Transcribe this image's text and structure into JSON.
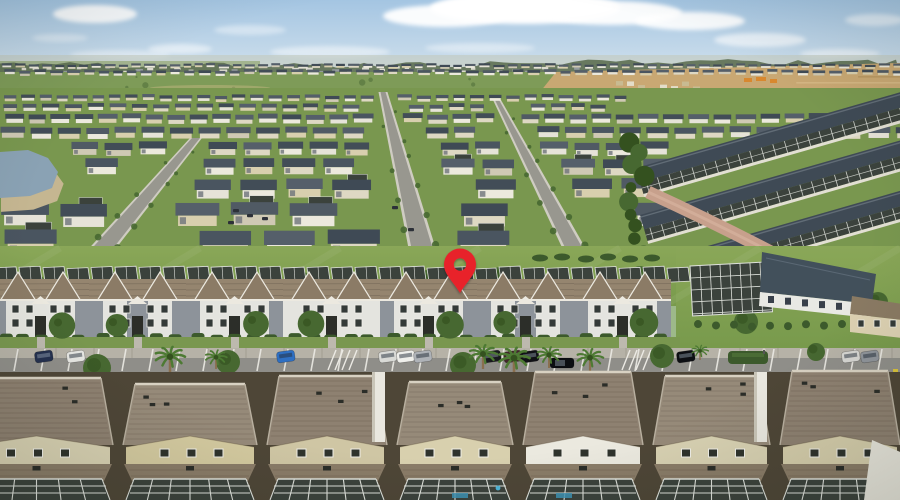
{
  "scene": {
    "description": "Aerial drone photo of a large suburban residential community: dense rows of houses stretching to the horizon under a blue sky with clouds, new construction land at upper right, a small pond at left, a row of two-story townhomes along a tree-lined parking street in the middle marked with a red map location pin, and large shingle roofs with screened pool enclosures in the foreground.",
    "marker": {
      "name": "map-pin",
      "x": 460,
      "top_y": 250,
      "tip_y": 293,
      "half_width": 16,
      "hole_cy": 264.5,
      "hole_radius": 6.2,
      "color": "#e8212b"
    },
    "palette": {
      "skyTop": "#a4c5e2",
      "skyMid": "#c6daea",
      "skyLow": "#dfe9ee",
      "cloud": "#ffffff",
      "haze": "#c3cbc0",
      "treeline": "#5d6f52",
      "treeline2": "#6b7d66",
      "fieldFar": "#9aad7e",
      "field": "#7e9b58",
      "fieldDot": "#5c7a42",
      "dirt": "#c9a873",
      "dirtLight": "#dcc190",
      "dirtDark": "#ad8c55",
      "orange": "#d8882f",
      "grass": "#79974f",
      "grassBelt1": "#8aa758",
      "grassBelt2": "#789a4c",
      "road": "#98978f",
      "roadEdge": "#cfccc2",
      "brick": "#c7a08c",
      "water": "#8aa2b4",
      "bank": "#c5b691",
      "roofs": [
        "#4a5560",
        "#3f4a55",
        "#555f6a",
        "#424d57",
        "#505a64"
      ],
      "walls": [
        "#ece9dd",
        "#ded8c3",
        "#d8cfae",
        "#e6e3d8",
        "#cfc9b4"
      ],
      "cage": "#3b423c",
      "cageFrame": "#dde0da",
      "townRoof": "#95856f",
      "townGable": "#8b7b66",
      "fascia": "#ece9e0",
      "facade": "#e4e4df",
      "facadeGray": "#8d939a",
      "windowDark": "#343a38",
      "trim": "#f0efe9",
      "porchDark": "#2c2e29",
      "hedge": "#3c5a2c",
      "tree": "#476831",
      "treeDark": "#34511f",
      "trunk": "#8a6f4e",
      "palm": "#4d7a33",
      "sidewalk": "#b6b2a7",
      "sidewalkJoint": "#a29d92",
      "asphalt": "#8f8e89",
      "stripe": "#eceae4",
      "foreBg": "#4e4637",
      "foreRoof": "#8e8171",
      "foreRoofAlt": "#968a79",
      "shingle": "rgba(64,52,40,0.18)",
      "ridge": "#d8d1c2",
      "lanai": "#8a7c68",
      "vent": "#2b2d28",
      "pool": "#3e93b5",
      "clubRoof": "#42505b",
      "clubWall": "#e9e9e4",
      "person": "#d8d4c8"
    },
    "sky": {
      "clouds": [
        [
          95,
          14,
          42,
          9,
          0.9
        ],
        [
          60,
          38,
          28,
          4,
          0.35
        ],
        [
          180,
          49,
          32,
          5,
          0.5
        ],
        [
          250,
          30,
          36,
          5,
          0.4
        ],
        [
          330,
          52,
          60,
          6,
          0.45
        ],
        [
          445,
          16,
          62,
          11,
          0.95
        ],
        [
          525,
          8,
          95,
          16,
          1
        ],
        [
          610,
          13,
          72,
          12,
          0.95
        ],
        [
          690,
          21,
          55,
          9,
          0.9
        ],
        [
          760,
          40,
          46,
          7,
          0.6
        ],
        [
          840,
          54,
          40,
          5,
          0.5
        ],
        [
          875,
          20,
          30,
          6,
          0.5
        ],
        [
          120,
          55,
          50,
          5,
          0.4
        ],
        [
          480,
          48,
          55,
          5,
          0.4
        ]
      ]
    },
    "development": {
      "rows": [
        {
          "y": 64,
          "h": 4,
          "x0": 0,
          "x1": 900
        },
        {
          "y": 70,
          "h": 5,
          "x0": 0,
          "x1": 900
        },
        {
          "y": 95,
          "h": 6,
          "x0": 0,
          "x1": 620
        },
        {
          "y": 104,
          "h": 7,
          "x0": 0,
          "x1": 610
        },
        {
          "y": 114,
          "h": 9,
          "x0": 0,
          "x1": 900
        },
        {
          "y": 127,
          "h": 11,
          "x0": 0,
          "x1": 900
        },
        {
          "y": 142,
          "h": 13,
          "x0": 0,
          "x1": 660
        },
        {
          "y": 159,
          "h": 16,
          "x0": 0,
          "x1": 655
        },
        {
          "y": 179,
          "h": 19,
          "x0": 0,
          "x1": 650
        },
        {
          "y": 203,
          "h": 23,
          "x0": 0,
          "x1": 645
        },
        {
          "y": 230,
          "h": 26,
          "x0": 0,
          "x1": 640
        }
      ],
      "streets": [
        {
          "x0": 383,
          "y0": 92,
          "x1": 424,
          "y1": 256,
          "w0": 5,
          "w1": 22
        },
        {
          "x0": 196,
          "y0": 138,
          "x1": 96,
          "y1": 256,
          "w0": 8,
          "w1": 22
        },
        {
          "x0": 497,
          "y0": 100,
          "x1": 578,
          "y1": 256,
          "w0": 4,
          "w1": 18
        }
      ],
      "distant_cars": [
        [
          233,
          209
        ],
        [
          247,
          214
        ],
        [
          228,
          221
        ],
        [
          262,
          217
        ],
        [
          392,
          206
        ],
        [
          408,
          228
        ]
      ]
    },
    "pond": {
      "points": "0,152 28,150 48,158 58,172 52,188 30,196 0,198"
    },
    "diagonal_rows": [
      {
        "x": 636,
        "y": 168
      },
      {
        "x": 640,
        "y": 215
      },
      {
        "x": 652,
        "y": 262
      }
    ],
    "tree_belt": {
      "x": 638,
      "y0": 135,
      "y1": 322,
      "count": 15
    },
    "green_belt": {
      "trees": [
        [
          33,
          286,
          13
        ],
        [
          300,
          282,
          11
        ],
        [
          428,
          283,
          13
        ],
        [
          500,
          279,
          12
        ],
        [
          560,
          288,
          9
        ],
        [
          640,
          276,
          10
        ],
        [
          746,
          322,
          12
        ],
        [
          878,
          302,
          10
        ],
        [
          112,
          280,
          8
        ]
      ],
      "bushes": [
        [
          540,
          258
        ],
        [
          562,
          257
        ],
        [
          586,
          259
        ],
        [
          608,
          257
        ],
        [
          630,
          259
        ],
        [
          652,
          258
        ]
      ]
    },
    "townhouse_row": {
      "x0": -8,
      "unit_width": 97,
      "units": [
        "A",
        "B",
        "A",
        "C",
        "A",
        "B",
        "A"
      ]
    },
    "street": {
      "stripe_step": 27,
      "hatch_zones": [
        336,
        630
      ],
      "hedge_island": {
        "x": 728,
        "w": 40
      },
      "parked_cars": [
        {
          "x": 44,
          "c": "#25314f"
        },
        {
          "x": 76,
          "c": "#e6e6e2"
        },
        {
          "x": 286,
          "c": "#2e6fc2"
        },
        {
          "x": 388,
          "c": "#d9dad6"
        },
        {
          "x": 406,
          "c": "#efefeb"
        },
        {
          "x": 423,
          "c": "#aeb2b7"
        },
        {
          "x": 492,
          "c": "#191a1e"
        },
        {
          "x": 513,
          "c": "#42262b"
        },
        {
          "x": 530,
          "c": "#101115"
        },
        {
          "x": 686,
          "c": "#0d0f13"
        },
        {
          "x": 851,
          "c": "#d6d6d2"
        },
        {
          "x": 870,
          "c": "#8f949a"
        }
      ],
      "moving_car": {
        "x": 562,
        "y": 363,
        "c": "#0c0e12"
      },
      "person": {
        "x": 764,
        "y": 350
      }
    },
    "street_trees": {
      "palms": [
        [
          170,
          373,
          1.25
        ],
        [
          216,
          369,
          0.9
        ],
        [
          483,
          369,
          1.15
        ],
        [
          514,
          375,
          1.3
        ],
        [
          549,
          368,
          1.0
        ],
        [
          590,
          372,
          1.1
        ],
        [
          700,
          360,
          0.7
        ]
      ],
      "round": [
        [
          97,
          368,
          14
        ],
        [
          228,
          362,
          12
        ],
        [
          463,
          365,
          13
        ],
        [
          662,
          356,
          12
        ],
        [
          816,
          352,
          9
        ]
      ]
    },
    "foreground": {
      "boundaries": [
        -45,
        118,
        262,
        392,
        518,
        648,
        775,
        905
      ],
      "ridges": [
        378,
        384,
        376,
        382,
        372,
        376,
        371
      ],
      "gables": [
        "#d8d1b2",
        "#d3c99f",
        "#cfc6a4",
        "#d8d0ae",
        "#ebe9df",
        "#d8d1b2",
        "#d5cdab"
      ],
      "white_walls": [
        378,
        760
      ],
      "pools": [
        452,
        556
      ],
      "float_x": 498
    }
  }
}
